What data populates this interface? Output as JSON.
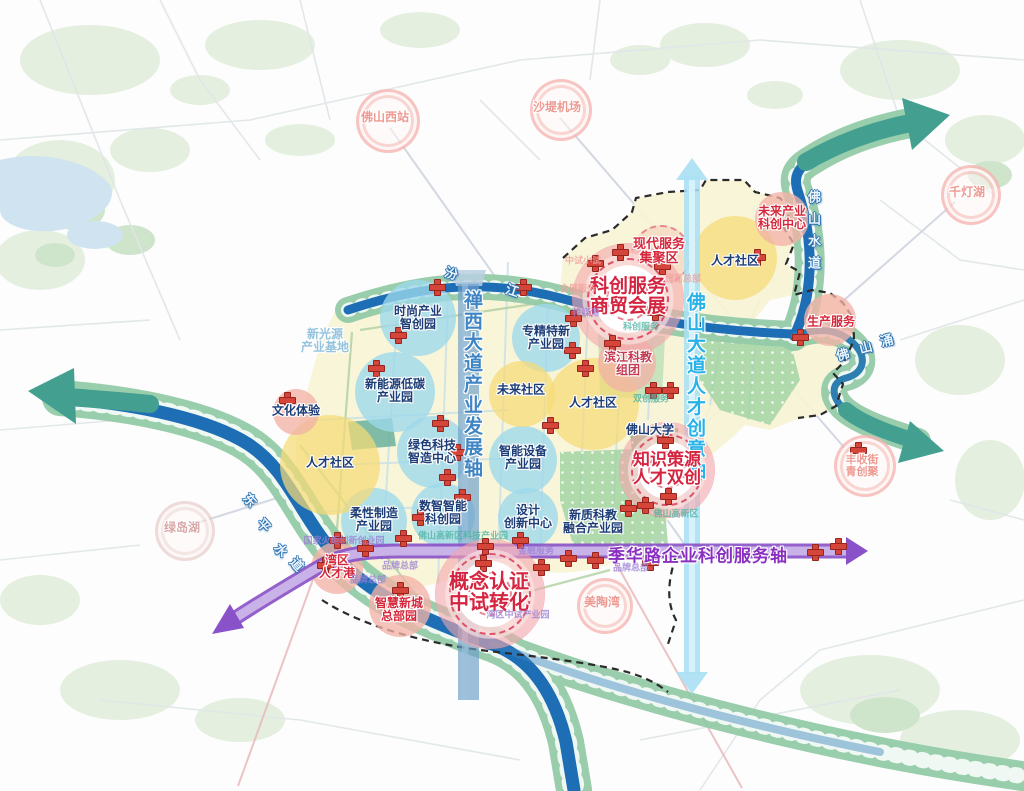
{
  "axes": {
    "chanxi": "禅西大道产业发展轴",
    "foshan_avenue": "佛山大道人才创意轴",
    "jihua": "季华路企业科创服务轴"
  },
  "major_nodes": {
    "kechuang": {
      "line1": "科创服务",
      "line2": "商贸会展"
    },
    "zhishi": {
      "line1": "知识策源",
      "line2": "人才双创"
    },
    "gainian": {
      "line1": "概念认证",
      "line2": "中试转化"
    },
    "xiandai": {
      "line1": "现代服务",
      "line2": "集聚区"
    }
  },
  "zones": {
    "shishang": {
      "line1": "时尚产业",
      "line2": "智创园"
    },
    "xinnengyuan": {
      "line1": "新能源低碳",
      "line2": "产业园"
    },
    "lvse": {
      "line1": "绿色科技",
      "line2": "智造中心"
    },
    "zhuanjing": {
      "line1": "专精特新",
      "line2": "产业园"
    },
    "zhineng": {
      "line1": "智能设备",
      "line2": "产业园"
    },
    "shuzhi": {
      "line1": "数智智能",
      "line2": "科创园"
    },
    "rouxing": {
      "line1": "柔性制造",
      "line2": "产业园"
    },
    "sheji": {
      "line1": "设计",
      "line2": "创新中心"
    },
    "binjiang": {
      "line1": "滨江科教",
      "line2": "组团"
    },
    "xinzhi": {
      "line1": "新质科教",
      "line2": "融合产业园"
    },
    "weilai_shequ": "未来社区",
    "rencai_left": "人才社区",
    "rencai_mid": "人才社区",
    "rencai_right": "人才社区",
    "weilai_chanye": {
      "line1": "未来产业",
      "line2": "科创中心"
    },
    "shengchan": "生产服务",
    "wenhua": "文化体验",
    "wanqu": {
      "line1": "湾区",
      "line2": "人才港"
    },
    "zhihui": {
      "line1": "智慧新城",
      "line2": "总部园"
    }
  },
  "landmarks": {
    "foshanxi": "佛山西站",
    "shadi": "沙堤机场",
    "qiandeng": "千灯湖",
    "fengshou": {
      "line1": "丰收街",
      "line2": "青创聚"
    },
    "meitao": "美陶湾",
    "lvdao": "绿岛湖",
    "foshan_univ": "佛山大学",
    "xinguangyuan": {
      "line1": "新光源",
      "line2": "产业基地"
    }
  },
  "rivers": {
    "fenjiang": [
      "汾",
      "江"
    ],
    "dongping": [
      "东",
      "平",
      "水",
      "道"
    ],
    "foshanshuidao": "佛山水道",
    "foshanyong": [
      "佛",
      "山",
      "涌"
    ]
  },
  "micro_labels": {
    "zhongshi": "中试小试",
    "huizhan": "会展服务",
    "chuanmei": "传媒港",
    "kechuangfuwu": "科创服务",
    "maoyi": "贸易总部",
    "shuangchuang": "双创服务",
    "gaoxin": "佛山高新区",
    "pinpai1": "品牌总部",
    "pinpai2": "品牌总部",
    "pinpai3": "品牌总部",
    "jinrong": "金融服务",
    "guojia": "国家火炬创新创业园",
    "keji_park": "佛山高新区科技产业园",
    "wanqu_zhongshi": "湾区中试产业园"
  },
  "colors": {
    "river": "#1e6eb6",
    "river_bank": "#94cba8",
    "axis_chanxi": "#6e9fc9",
    "axis_foshan": "#a9e0f4",
    "axis_jihua": "#8a52c8",
    "node_ring": "#e87f8e",
    "cross_red": "#d6453a",
    "zone_blue": "#9cd8ec",
    "zone_yellow": "#f5db76",
    "zone_pink": "#f2b2a6"
  }
}
